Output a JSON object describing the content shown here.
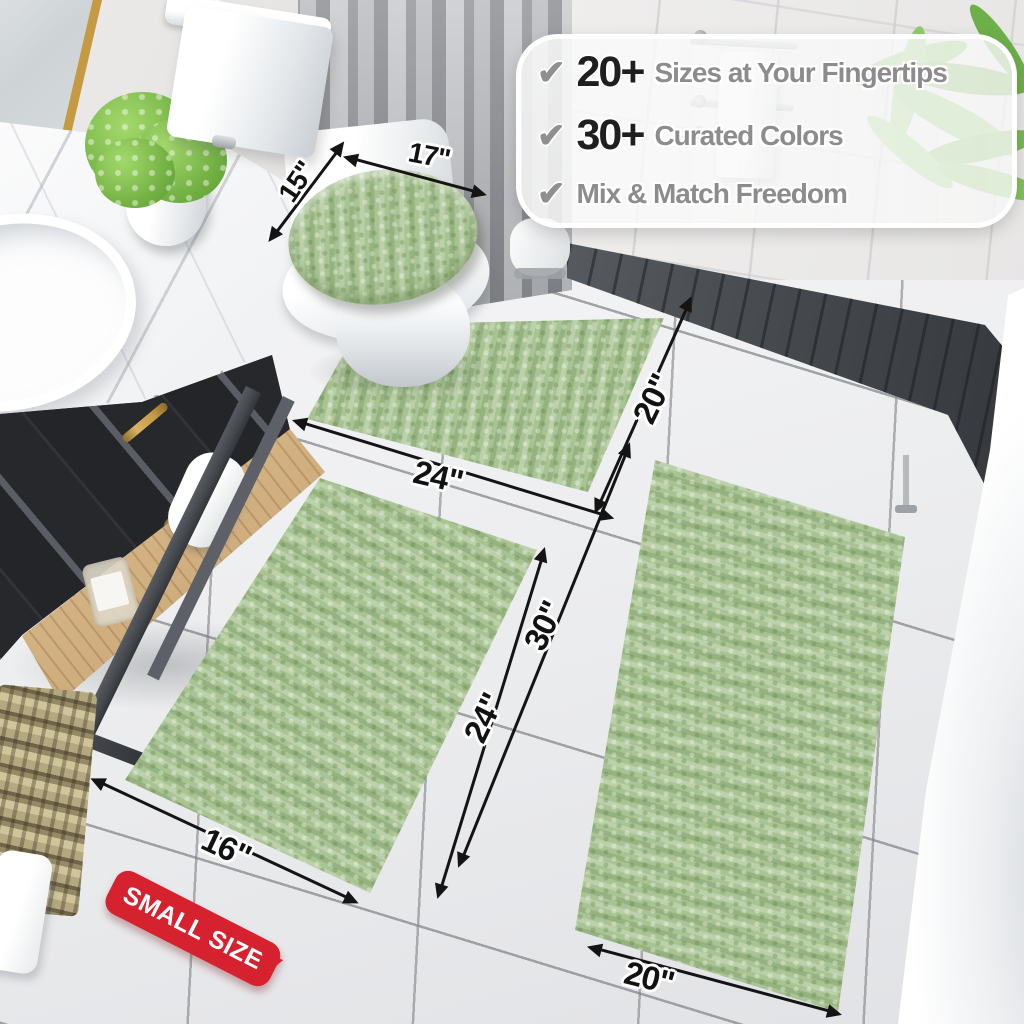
{
  "banner": {
    "items": [
      {
        "icon": "checkmark",
        "value": "20+",
        "label": "Sizes at Your Fingertips"
      },
      {
        "icon": "checkmark",
        "value": "30+",
        "label": "Curated Colors"
      },
      {
        "icon": "checkmark",
        "value": "",
        "label": "Mix & Match Freedom"
      }
    ]
  },
  "measurements": {
    "toilet_lid_cover": {
      "width": "17\"",
      "depth": "15\""
    },
    "contour_rug": {
      "width": "24\"",
      "depth": "20\""
    },
    "small_rug": {
      "width": "16\"",
      "depth": "24\""
    },
    "large_rug": {
      "width": "20\"",
      "depth": "30\""
    }
  },
  "badge": {
    "label": "SMALL SIZE"
  },
  "colors": {
    "rug_green": "#a9c493",
    "badge_red": "#d6212e",
    "annotation_black": "#141414",
    "banner_number": "#1f1f1f",
    "banner_text": "#8c8c8c",
    "checkmark_gray": "#8f8f8f"
  }
}
